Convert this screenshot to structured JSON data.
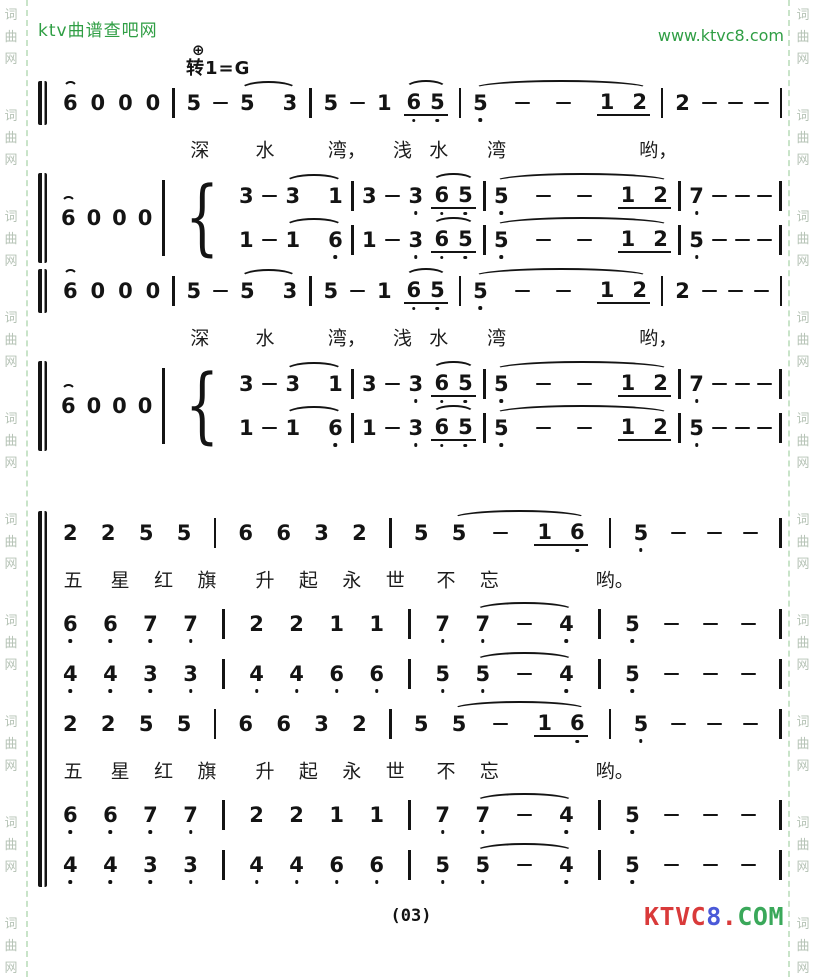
{
  "header": {
    "site_name": "ktv曲谱查吧网",
    "site_url": "www.ktvc8.com",
    "coda_symbol": "⊕",
    "key_change": "转1=G",
    "accent_color": "#2f9e44"
  },
  "watermark": {
    "chars": [
      "词",
      "曲",
      "网"
    ],
    "color": "#b6c3b6"
  },
  "score": {
    "note_color": "#141414",
    "blocks": [
      {
        "type": "single",
        "tokens": "( 6 ) 0 0 0 | 5 - ( 5 3 ) | 5 - 1 ( 6d5d ) | ( 5d - - 1w2 ) | 2 - - - |"
      },
      {
        "type": "lyrics",
        "items": [
          {
            "t": "深",
            "x": 18
          },
          {
            "t": "水",
            "x": 27
          },
          {
            "t": "湾，",
            "x": 37
          },
          {
            "t": "浅",
            "x": 46
          },
          {
            "t": "水",
            "x": 51
          },
          {
            "t": "湾",
            "x": 59
          },
          {
            "t": "哟，",
            "x": 80
          }
        ]
      },
      {
        "type": "dual",
        "lead": "( 6 ) 0 0 0 | {",
        "upper": "3 - ( 3 1 ) | 3 - 3d ( 6d5d ) | ( 5d - - 1w2 ) | 7d - - - |",
        "lower": "1 - ( 1 6d ) | 1 - 3d ( 6d5d ) | ( 5d - - 1w2 ) | 5d - - - |"
      },
      {
        "type": "single",
        "tokens": "( 6 ) 0 0 0 | 5 - ( 5 3 ) | 5 - 1 ( 6d5d ) | ( 5d - - 1w2 ) | 2 - - - |"
      },
      {
        "type": "lyrics",
        "items": [
          {
            "t": "深",
            "x": 18
          },
          {
            "t": "水",
            "x": 27
          },
          {
            "t": "湾，",
            "x": 37
          },
          {
            "t": "浅",
            "x": 46
          },
          {
            "t": "水",
            "x": 51
          },
          {
            "t": "湾",
            "x": 59
          },
          {
            "t": "哟，",
            "x": 80
          }
        ]
      },
      {
        "type": "dual",
        "lead": "( 6 ) 0 0 0 | {",
        "upper": "3 - ( 3 1 ) | 3 - 3d ( 6d5d ) | ( 5d - - 1w2 ) | 7d - - - |",
        "lower": "1 - ( 1 6d ) | 1 - 3d ( 6d5d ) | ( 5d - - 1w2 ) | 5d - - - |"
      },
      {
        "type": "gap"
      },
      {
        "type": "group",
        "blocks": [
          {
            "type": "single",
            "tokens": "2 2 5 5 | 6 6 3 2 | 5 ( 5 - 1w6d ) | 5d - - - |"
          },
          {
            "type": "lyrics",
            "items": [
              {
                "t": "五",
                "x": 0.5
              },
              {
                "t": "星",
                "x": 7
              },
              {
                "t": "红",
                "x": 13
              },
              {
                "t": "旗",
                "x": 19
              },
              {
                "t": "升",
                "x": 27
              },
              {
                "t": "起",
                "x": 33
              },
              {
                "t": "永",
                "x": 39
              },
              {
                "t": "世",
                "x": 45
              },
              {
                "t": "不",
                "x": 52
              },
              {
                "t": "忘",
                "x": 58
              },
              {
                "t": "哟。",
                "x": 74
              }
            ]
          },
          {
            "type": "single",
            "tokens": "6d 6d 7d 7d | 2 2 1 1 | 7d ( 7d - 4d ) | 5d - - - |"
          },
          {
            "type": "single",
            "tokens": "4d 4d 3d 3d | 4d 4d 6d 6d | 5d ( 5d - 4d ) | 5d - - - |"
          },
          {
            "type": "single",
            "tokens": "2 2 5 5 | 6 6 3 2 | 5 ( 5 - 1w6d ) | 5d - - - |"
          },
          {
            "type": "lyrics",
            "items": [
              {
                "t": "五",
                "x": 0.5
              },
              {
                "t": "星",
                "x": 7
              },
              {
                "t": "红",
                "x": 13
              },
              {
                "t": "旗",
                "x": 19
              },
              {
                "t": "升",
                "x": 27
              },
              {
                "t": "起",
                "x": 33
              },
              {
                "t": "永",
                "x": 39
              },
              {
                "t": "世",
                "x": 45
              },
              {
                "t": "不",
                "x": 52
              },
              {
                "t": "忘",
                "x": 58
              },
              {
                "t": "哟。",
                "x": 74
              }
            ]
          },
          {
            "type": "single",
            "tokens": "6d 6d 7d 7d | 2 2 1 1 | 7d ( 7d - 4d ) | 5d - - - |"
          },
          {
            "type": "single",
            "tokens": "4d 4d 3d 3d | 4d 4d 6d 6d | 5d ( 5d - 4d ) | 5d - - - |"
          }
        ]
      }
    ]
  },
  "footer": {
    "page_number": "(03)",
    "logo_segments": [
      {
        "text": "KTVC",
        "color": "#d93a3a"
      },
      {
        "text": "8",
        "color": "#4a59d8"
      },
      {
        "text": ".",
        "color": "#d93a3a"
      },
      {
        "text": "COM",
        "color": "#3aa85a"
      }
    ]
  }
}
